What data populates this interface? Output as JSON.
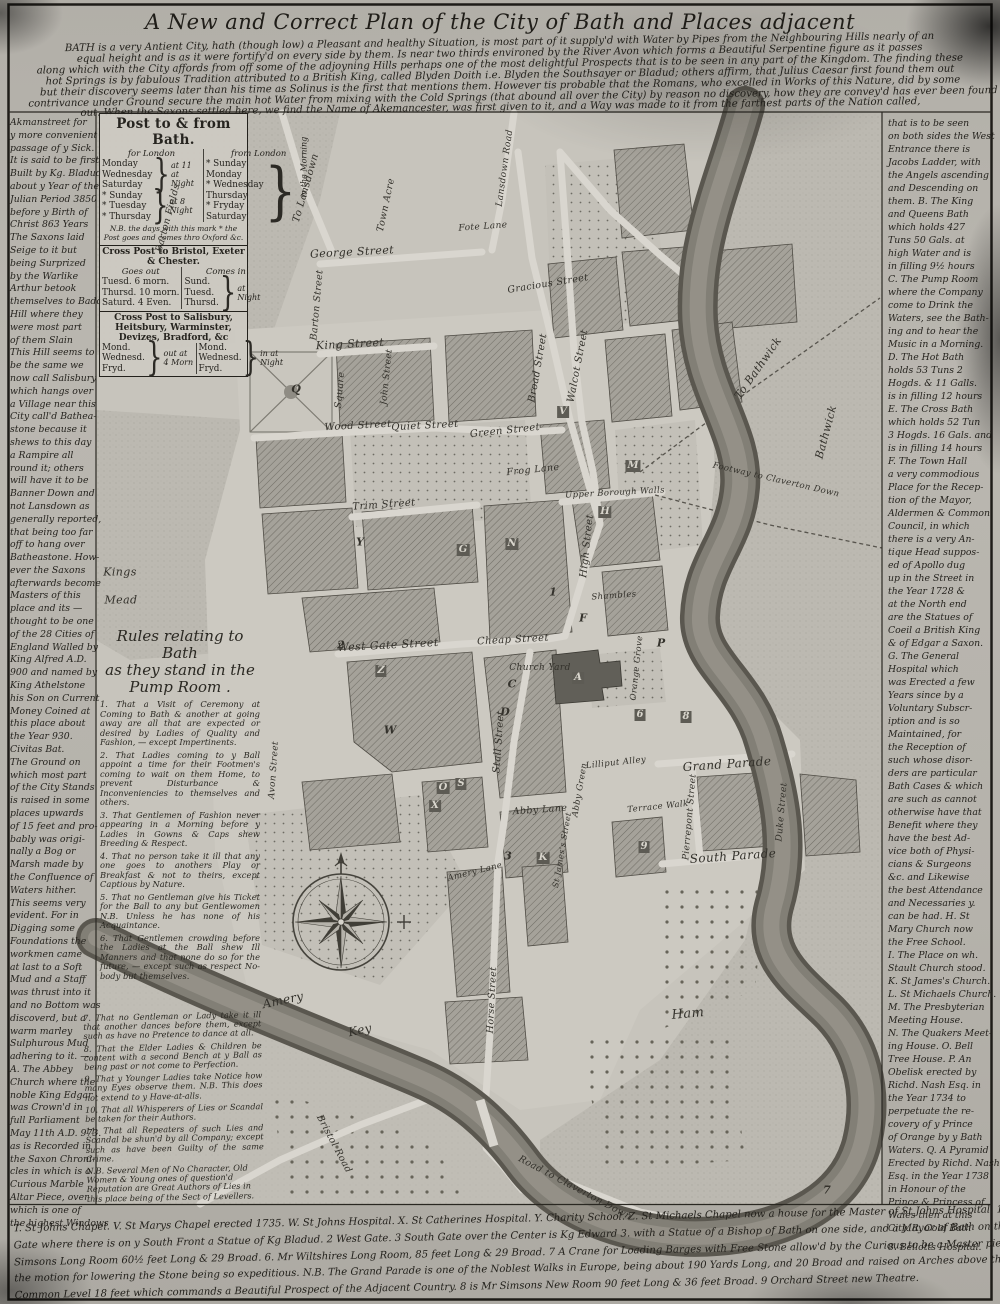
{
  "title": "A New and Correct Plan of the City of Bath and Places adjacent",
  "intro_lines": [
    "BATH is a very Antient City, hath (though low) a Pleasant and healthy Situation, is most part of it supply'd with Water by Pipes from the Neighbouring Hills nearly of an",
    "equal height and is as it were fortify'd on every side by them. Is near two thirds environed by the River Avon which forms a Beautiful Serpentine figure as it passes",
    "along which with the City affords from off some of the adjoyning Hills perhaps one of the most delightful Prospects that is to be seen in any part of the Kingdom. The finding these",
    "hot Springs is by fabulous Tradition attributed to a British King, called Blyden Doith i.e. Blyden the Southsayer or Bladud; others affirm, that Julius Caesar first found them out",
    "but their discovery seems later than his time as Solinus is the first that mentions them. However tis probable that the Romans, who excelled in Works of this Nature, did by some",
    "contrivance under Ground secure the main hot Water from mixing with the Cold Springs (that abound all over the City) by reason no discovery, how they are convey'd has ever been found",
    "out. When the Saxons settled here, we find the Name of Akemancester, was first given to it, and a Way was made to it from the farthest parts of the Nation called,"
  ],
  "left_margin_lines": [
    "Akmanstreet for",
    "y more convenient",
    "passage of y Sick.",
    "It is said to be first",
    "Built by Kg. Bladud",
    "about y Year of the",
    "Julian Period 3850",
    "before y Birth of",
    "Christ 863 Years",
    "The Saxons laid",
    "Seige to it but",
    "being Surprized",
    "by the Warlike",
    "Arthur betook",
    "themselves to Badon",
    "Hill where they",
    "were most part",
    "of them Slain",
    "This Hill seems to",
    "be the same we",
    "now call Salisbury",
    "which hangs over",
    "a Village near this",
    "City call'd Bathea-",
    "stone because it",
    "shews to this day",
    "a Rampire all",
    "round it; others",
    "will have it to be",
    "Banner Down and",
    "not Lansdown as",
    "generally reported,",
    "that being too far",
    "off to hang over",
    "Batheastone. How-",
    "ever the Saxons",
    "afterwards become",
    "Masters of this",
    "place and its —",
    "thought to be one",
    "of the 28 Cities of",
    "England Walled by",
    "King Alfred A.D.",
    "900 and named by",
    "King Athelstone",
    "his Son on Current",
    "Money Coined at",
    "this place about",
    "the Year 930.",
    "Civitas Bat.",
    "The Ground on",
    "which most part",
    "of the City Stands",
    "is raised in some",
    "places upwards",
    "of 15 feet and pro-",
    "bably was origi-",
    "nally a Bog or",
    "Marsh made by",
    "the Confluence of",
    "Waters hither.",
    "This seems very",
    "evident. For in",
    "Digging some",
    "Foundations the",
    "workmen came",
    "at last to a Soft",
    "Mud and a Staff",
    "was thrust into it",
    "and no Bottom was",
    "discoverd, but a",
    "warm marley",
    "Sulphurous Mud",
    "adhering to it. —",
    "A. The Abbey",
    "Church where the",
    "noble King Edgar",
    "was Crown'd in",
    "full Parliament",
    "May 11th A.D. 973.",
    "as is Recorded in",
    "the Saxon Chroni-",
    "cles in which is a",
    "Curious Marble",
    "Altar Piece, over",
    "which is one of",
    "the highest Windows"
  ],
  "right_margin_lines": [
    "that is to be seen",
    "on both sides the West",
    "Entrance there is",
    "Jacobs Ladder, with",
    "the Angels ascending",
    "and Descending on",
    "them. B. The King",
    "and Queens Bath",
    "which holds 427",
    "Tuns 50 Gals. at",
    "high Water and is",
    "in filling 9½ hours",
    "C. The Pump Room",
    "where the Company",
    "come to Drink the",
    "Waters, see the Bath-",
    "ing and to hear the",
    "Music in a Morning.",
    "D. The Hot Bath",
    "holds 53 Tuns 2",
    "Hogds. & 11 Galls.",
    "is in filling 12 hours",
    "E. The Cross Bath",
    "which holds 52 Tun",
    "3 Hogds. 16 Gals. and",
    "is in filling 14 hours",
    "F. The Town Hall",
    "a very commodious",
    "Place for the Recep-",
    "tion of the Mayor,",
    "Aldermen & Common",
    "Council, in which",
    "there is a very An-",
    "tique Head suppos-",
    "ed of Apollo dug",
    "up in the Street in",
    "the Year 1728 &",
    "at the North end",
    "are the Statues of",
    "Coeil a British King",
    "& of Edgar a Saxon.",
    "G. The General",
    "Hospital which",
    "was Erected a few",
    "Years since by a",
    "Voluntary Subscr-",
    "iption and is so",
    "Maintained, for",
    "the Reception of",
    "such whose disor-",
    "ders are particular",
    "Bath Cases & which",
    "are such as cannot",
    "otherwise have that",
    "Benefit where they",
    "have the best Ad-",
    "vice both of Physi-",
    "cians & Surgeons",
    "&c. and Likewise",
    "the best Attendance",
    "and Necessaries y.",
    "can be had. H. St",
    "Mary Church now",
    "the Free School.",
    "I. The Place on wh.",
    "Stault Church stood.",
    "K. St James's Church.",
    "L. St Michaels Church.",
    "M. The Presbyterian",
    "Meeting House.",
    "N. The Quakers Meet-",
    "ing House. O. Bell",
    "Tree House. P. An",
    "Obelisk erected by",
    "Richd. Nash Esq. in",
    "the Year 1734 to",
    "perpetuate the re-",
    "covery of y Prince",
    "of Orange by y Bath",
    "Waters. Q. A Pyramid",
    "Erected by Richd. Nash",
    "Esq. in the Year 1738",
    "in Honour of the",
    "Prince & Princess of",
    "Wales then at this",
    "City. R. Cold Bath"
  ],
  "corner_note": "8. Bellotts Hospital.",
  "post_table": {
    "title": "Post to & from Bath.",
    "for_london_header": "for London",
    "from_london_header": "from London",
    "for_london_groups": [
      {
        "days": [
          "Monday",
          "Wednesday",
          "Saturday"
        ],
        "time": "at 11 at Night"
      },
      {
        "days": [
          "* Sunday",
          "* Tuesday",
          "* Thursday"
        ],
        "time": "at 8 Night"
      }
    ],
    "from_london_days": [
      "* Sunday",
      "Monday",
      "* Wednesday",
      "Thursday",
      "* Fryday",
      "Saturday"
    ],
    "from_london_time": "in the Morning",
    "note": "N.B. the days with this mark * the Post goes and comes thro Oxford &c.",
    "cross_post_1": {
      "title": "Cross Post to Bristol, Exeter & Chester.",
      "out_header": "Goes out",
      "in_header": "Comes in",
      "out_rows": [
        "Tuesd. 6 morn.",
        "Thursd. 10 morn.",
        "Saturd. 4 Even."
      ],
      "in_days": [
        "Sund.",
        "Tuesd.",
        "Thursd."
      ],
      "in_time": "at Night"
    },
    "cross_post_2": {
      "title": "Cross Post to Salisbury, Heitsbury, Warminster, Devizes, Bradford, &c",
      "out_days": [
        "Mond.",
        "Wednesd.",
        "Fryd."
      ],
      "out_time": "out at 4 Morn",
      "in_days": [
        "Mond.",
        "Wednesd.",
        "Fryd."
      ],
      "in_time": "in at Night"
    }
  },
  "rules": {
    "title_lines": [
      "Rules relating to Bath",
      "as they stand in the",
      "Pump Room ."
    ],
    "items": [
      "1. That a Visit of Ceremony at Coming to Bath & another at going away are all that are expected or desired by Ladies of Quality and Fashion, — except Impertinents.",
      "2. That Ladies coming to y Ball appoint a time for their Footmen's coming to wait on them Home, to prevent Disturbance & Inconveniencies to themselves and others.",
      "3. That Gentlemen of Fashion never appearing in a Morning before y Ladies in Gowns & Caps shew Breeding & Respect.",
      "4. That no person take it ill that any one goes to anothers Play or Breakfast & not to theirs, except Captious by Nature.",
      "5. That no Gentleman give his Ticket for the Ball to any but Gentlewomen N.B. Unless he has none of his Acquaintance.",
      "6. That Gentlemen crowding before the Ladies at the Ball shew Ill Manners and that none do so for the future, — except such as respect No-body but themselves."
    ]
  },
  "rules_continued": {
    "items": [
      "7. That no Gentleman or Lady take it ill that another dances before them, except such as have no Pretence to dance at all.",
      "8. That the Elder Ladies & Children be content with a second Bench at y Ball as being past or not come to Perfection.",
      "9. That y Younger Ladies take Notice how many Eyes observe them. N.B. This does not extend to y Have-at-alls.",
      "10. That all Whisperers of Lies or Scandal be taken for their Authors.",
      "11. That all Repeaters of such Lies and Scandal be shun'd by all Company; except such as have been Guilty of the same Crime."
    ],
    "note": "N.B. Several Men of No Character, Old Women & Young ones of question'd Reputation are Great Authors of Lies in this place being of the Sect of Levellers."
  },
  "bottom_lines": [
    "T. St Johns Chapel. V. St Marys Chapel erected 1735. W. St Johns Hospital. X. St Catherines Hospital. Y. Charity School. Z. St Michaels Chapel now a house for the Master of St Johns Hospital. 1 North",
    "Gate where there is on y South Front a Statue of Kg Bladud. 2 West Gate. 3 South Gate over the Center is Kg Edward 3. with a Statue of a Bishop of Bath on one side, and a Mayor of Bath on the other. 5 Mr",
    "Simsons Long Room 60½ feet Long & 29 Broad. 6. Mr Wiltshires Long Room, 85 feet Long & 29 Broad. 7 A Crane for Loading Barges with Free Stone allow'd by the Curious to be a Master piece of Mechanism,",
    "the motion for lowering the Stone being so expeditious. N.B. The Grand Parade is one of the Noblest Walks in Europe, being about 190 Yards Long, and 20 Broad and raised on Arches above the",
    "Common Level 18 feet which commands a Beautiful Prospect of the Adjacent Country. 8 is Mr Simsons New Room 90 feet Long & 36 feet Broad. 9 Orchard Street new Theatre."
  ],
  "map": {
    "labels": [
      {
        "t": "George Street",
        "x": 352,
        "y": 252,
        "r": -3,
        "s": 11
      },
      {
        "t": "King Street",
        "x": 350,
        "y": 344,
        "r": -3,
        "s": 11
      },
      {
        "t": "To Lansdown",
        "x": 306,
        "y": 188,
        "r": -74,
        "s": 10
      },
      {
        "t": "Town Acre",
        "x": 386,
        "y": 205,
        "r": -78,
        "s": 9.5
      },
      {
        "t": "Lansdown Road",
        "x": 505,
        "y": 168,
        "r": -82,
        "s": 9
      },
      {
        "t": "Fote Lane",
        "x": 483,
        "y": 227,
        "r": -4,
        "s": 9
      },
      {
        "t": "Gracious Street",
        "x": 548,
        "y": 284,
        "r": -9,
        "s": 9.5
      },
      {
        "t": "Barton Street",
        "x": 317,
        "y": 305,
        "r": -85,
        "s": 9.5
      },
      {
        "t": "Barton Fields",
        "x": 168,
        "y": 218,
        "r": -75,
        "s": 9.5
      },
      {
        "t": "Square",
        "x": 340,
        "y": 390,
        "r": -85,
        "s": 9.5
      },
      {
        "t": "Wood Street",
        "x": 358,
        "y": 426,
        "r": -3,
        "s": 10
      },
      {
        "t": "John Street",
        "x": 387,
        "y": 377,
        "r": -84,
        "s": 9
      },
      {
        "t": "Quiet Street",
        "x": 425,
        "y": 426,
        "r": -3,
        "s": 10
      },
      {
        "t": "Green Street",
        "x": 505,
        "y": 431,
        "r": -6,
        "s": 10
      },
      {
        "t": "Broad Street",
        "x": 538,
        "y": 368,
        "r": -80,
        "s": 10
      },
      {
        "t": "Walcot Street",
        "x": 578,
        "y": 366,
        "r": -79,
        "s": 10
      },
      {
        "t": "Frog Lane",
        "x": 533,
        "y": 470,
        "r": -6,
        "s": 9.5
      },
      {
        "t": "Trim Street",
        "x": 384,
        "y": 505,
        "r": -4,
        "s": 10
      },
      {
        "t": "Upper Borough Walls",
        "x": 615,
        "y": 493,
        "r": -3,
        "s": 8.5
      },
      {
        "t": "High Street",
        "x": 587,
        "y": 546,
        "r": -84,
        "s": 10
      },
      {
        "t": "Shambles",
        "x": 614,
        "y": 596,
        "r": -4,
        "s": 8.5
      },
      {
        "t": "West Gate Street",
        "x": 388,
        "y": 645,
        "r": -3,
        "s": 11
      },
      {
        "t": "Cheap Street",
        "x": 513,
        "y": 640,
        "r": -3,
        "s": 10
      },
      {
        "t": "Church Yard",
        "x": 540,
        "y": 668,
        "r": 0,
        "s": 9
      },
      {
        "t": "Stall Street",
        "x": 499,
        "y": 742,
        "r": -86,
        "s": 10
      },
      {
        "t": "Abby Lane",
        "x": 540,
        "y": 810,
        "r": -4,
        "s": 9.5
      },
      {
        "t": "Lilliput Alley",
        "x": 616,
        "y": 763,
        "r": -6,
        "s": 8.5
      },
      {
        "t": "Abby Green",
        "x": 580,
        "y": 790,
        "r": -80,
        "s": 8.5
      },
      {
        "t": "Orange Grove",
        "x": 637,
        "y": 668,
        "r": -84,
        "s": 8.5
      },
      {
        "t": "Terrace Walk",
        "x": 658,
        "y": 807,
        "r": -6,
        "s": 8.5
      },
      {
        "t": "Pierrepont Street",
        "x": 690,
        "y": 817,
        "r": -85,
        "s": 9
      },
      {
        "t": "Grand Parade",
        "x": 727,
        "y": 764,
        "r": -4,
        "s": 12
      },
      {
        "t": "South Parade",
        "x": 733,
        "y": 856,
        "r": -4,
        "s": 12
      },
      {
        "t": "Duke Street",
        "x": 782,
        "y": 812,
        "r": -85,
        "s": 9
      },
      {
        "t": "Kings",
        "x": 120,
        "y": 572,
        "r": 0,
        "s": 11
      },
      {
        "t": "Mead",
        "x": 121,
        "y": 600,
        "r": 0,
        "s": 11
      },
      {
        "t": "Avon Street",
        "x": 274,
        "y": 770,
        "r": -86,
        "s": 9
      },
      {
        "t": "Amery",
        "x": 283,
        "y": 1000,
        "r": -12,
        "s": 12
      },
      {
        "t": "Key",
        "x": 360,
        "y": 1030,
        "r": -12,
        "s": 12
      },
      {
        "t": "Amery Lane",
        "x": 475,
        "y": 872,
        "r": -14,
        "s": 8.5
      },
      {
        "t": "Horse Street",
        "x": 492,
        "y": 1000,
        "r": -87,
        "s": 9.5
      },
      {
        "t": "St James's Street",
        "x": 562,
        "y": 850,
        "r": -80,
        "s": 8
      },
      {
        "t": "Ham",
        "x": 688,
        "y": 1014,
        "r": -5,
        "s": 13
      },
      {
        "t": "To Bathwick",
        "x": 758,
        "y": 368,
        "r": -55,
        "s": 11
      },
      {
        "t": "Bathwick",
        "x": 826,
        "y": 432,
        "r": -75,
        "s": 11
      },
      {
        "t": "Footway to Claverton Down",
        "x": 776,
        "y": 480,
        "r": 13,
        "s": 8.5
      },
      {
        "t": "Road to Claverton Down",
        "x": 575,
        "y": 1188,
        "r": 28,
        "s": 9.5
      },
      {
        "t": "Bristol Road",
        "x": 334,
        "y": 1144,
        "r": 62,
        "s": 9.5
      }
    ],
    "markers": [
      {
        "t": "Q",
        "x": 296,
        "y": 389
      },
      {
        "t": "V",
        "x": 563,
        "y": 412,
        "b": 1
      },
      {
        "t": "M",
        "x": 633,
        "y": 466,
        "b": 1
      },
      {
        "t": "H",
        "x": 605,
        "y": 512,
        "b": 1
      },
      {
        "t": "Y",
        "x": 360,
        "y": 542
      },
      {
        "t": "G",
        "x": 463,
        "y": 550,
        "b": 1
      },
      {
        "t": "N",
        "x": 512,
        "y": 544,
        "b": 1
      },
      {
        "t": "F",
        "x": 583,
        "y": 618
      },
      {
        "t": "1",
        "x": 553,
        "y": 592
      },
      {
        "t": "Z",
        "x": 381,
        "y": 671,
        "b": 1
      },
      {
        "t": "A",
        "x": 578,
        "y": 678,
        "b": 1
      },
      {
        "t": "C",
        "x": 512,
        "y": 684
      },
      {
        "t": "D",
        "x": 505,
        "y": 712
      },
      {
        "t": "W",
        "x": 390,
        "y": 730
      },
      {
        "t": "P",
        "x": 661,
        "y": 643
      },
      {
        "t": "O",
        "x": 443,
        "y": 788,
        "b": 1
      },
      {
        "t": "S",
        "x": 461,
        "y": 784,
        "b": 1
      },
      {
        "t": "X",
        "x": 435,
        "y": 806,
        "b": 1
      },
      {
        "t": "K",
        "x": 543,
        "y": 858,
        "b": 1
      },
      {
        "t": "2",
        "x": 341,
        "y": 645
      },
      {
        "t": "3",
        "x": 508,
        "y": 856
      },
      {
        "t": "6",
        "x": 640,
        "y": 715,
        "b": 1
      },
      {
        "t": "8",
        "x": 686,
        "y": 717,
        "b": 1
      },
      {
        "t": "9",
        "x": 644,
        "y": 847,
        "b": 1
      },
      {
        "t": "7",
        "x": 827,
        "y": 1190
      }
    ]
  }
}
